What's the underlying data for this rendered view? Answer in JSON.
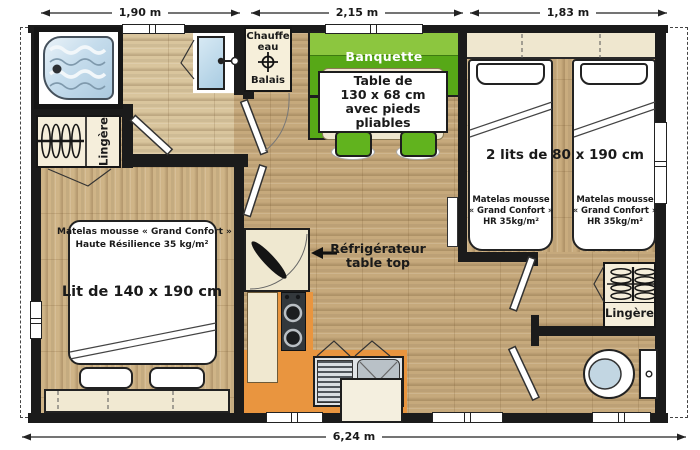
{
  "colors": {
    "wall": "#1b1b1b",
    "wood": "#c6a97c",
    "wood_light": "#d9c59d",
    "orange_kitchen": "#e9953f",
    "green_bench_back": "#8cc63f",
    "green_bench_seat": "#57a817",
    "green_stool": "#61b31e",
    "blue_fixture": "#bdd7e8",
    "beige_closet": "#f5eedb"
  },
  "plan": {
    "dims": {
      "top": [
        "1,90 m",
        "2,15 m",
        "1,83 m"
      ],
      "bottom": "6,24 m"
    },
    "utility_closet": {
      "l1": "Chauffe",
      "l2": "eau",
      "l3": "Balais"
    },
    "linen_left": {
      "label": "Lingère"
    },
    "linen_right": {
      "label": "Lingère"
    },
    "dining": {
      "bench": "Banquette",
      "table": [
        "Table de",
        "130 x 68 cm",
        "avec pieds",
        "pliables"
      ]
    },
    "kitchen": {
      "fridge": [
        "Réfrigérateur",
        "table top"
      ]
    },
    "master_bedroom": {
      "mattress": [
        "Matelas mousse « Grand Confort »",
        "Haute Résilience 35 kg/m²"
      ],
      "bed": "Lit de 140 x 190 cm"
    },
    "kids_bedroom": {
      "beds": "2 lits de 80 x 190 cm",
      "mattress_left": [
        "Matelas mousse",
        "« Grand Confort »",
        "HR 35kg/m²"
      ],
      "mattress_right": [
        "Matelas mousse",
        "« Grand Confort »",
        "HR 35kg/m²"
      ]
    }
  }
}
